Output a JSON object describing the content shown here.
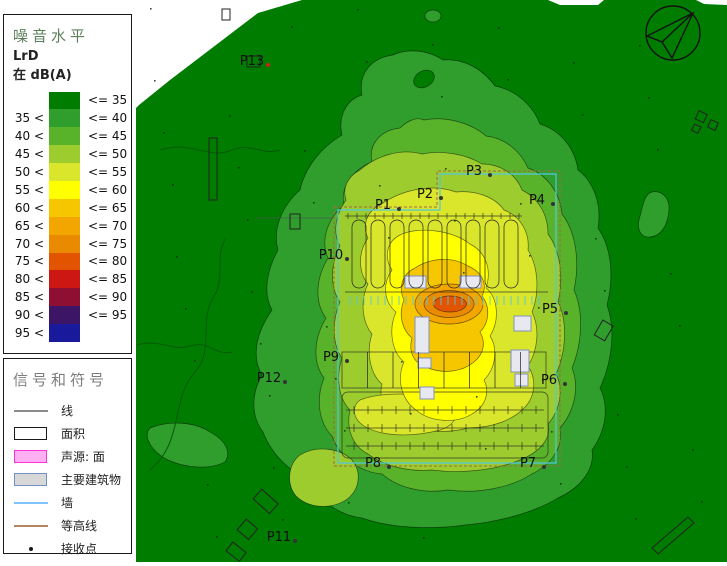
{
  "noise_legend": {
    "title": "噪音水平",
    "quantity": "LrD",
    "unit_line": "在 dB(A)",
    "rows": [
      {
        "from": "",
        "to": "<= 35",
        "color": "#007d00"
      },
      {
        "from": "35 <",
        "to": "<= 40",
        "color": "#2f9e2d"
      },
      {
        "from": "40 <",
        "to": "<= 45",
        "color": "#58b22a"
      },
      {
        "from": "45 <",
        "to": "<= 50",
        "color": "#9ccc2e"
      },
      {
        "from": "50 <",
        "to": "<= 55",
        "color": "#d9e62b"
      },
      {
        "from": "55 <",
        "to": "<= 60",
        "color": "#ffff00"
      },
      {
        "from": "60 <",
        "to": "<= 65",
        "color": "#f6c700"
      },
      {
        "from": "65 <",
        "to": "<= 70",
        "color": "#f4a600"
      },
      {
        "from": "70 <",
        "to": "<= 75",
        "color": "#ea8a00"
      },
      {
        "from": "75 <",
        "to": "<= 80",
        "color": "#e35400"
      },
      {
        "from": "80 <",
        "to": "<= 85",
        "color": "#cd1712"
      },
      {
        "from": "85 <",
        "to": "<= 90",
        "color": "#8f0f32"
      },
      {
        "from": "90 <",
        "to": "<= 95",
        "color": "#3c1566"
      },
      {
        "from": "95 <",
        "to": "",
        "color": "#19199b"
      }
    ]
  },
  "symbol_legend": {
    "title": "信号和符号",
    "items": [
      {
        "label": "线",
        "type": "line",
        "color": "#8c8c8c"
      },
      {
        "label": "面积",
        "type": "rect",
        "fill": "#ffffff",
        "border": "#1a1a1a"
      },
      {
        "label": "声源: 面",
        "type": "rect",
        "fill": "#ffb0f2",
        "border": "#ff30e0"
      },
      {
        "label": "主要建筑物",
        "type": "rect",
        "fill": "#d8d8d8",
        "border": "#7090c8"
      },
      {
        "label": "墙",
        "type": "line",
        "color": "#7fc3ff"
      },
      {
        "label": "等高线",
        "type": "line",
        "color": "#b8835f"
      },
      {
        "label": "接收点",
        "type": "dot",
        "color": "#1a1a1a"
      }
    ]
  },
  "map": {
    "receivers": [
      {
        "id": "P1",
        "x": 383,
        "y": 205
      },
      {
        "id": "P2",
        "x": 425,
        "y": 194
      },
      {
        "id": "P3",
        "x": 474,
        "y": 171
      },
      {
        "id": "P4",
        "x": 537,
        "y": 200
      },
      {
        "id": "P5",
        "x": 550,
        "y": 309
      },
      {
        "id": "P6",
        "x": 549,
        "y": 380
      },
      {
        "id": "P7",
        "x": 528,
        "y": 463
      },
      {
        "id": "P8",
        "x": 373,
        "y": 463
      },
      {
        "id": "P9",
        "x": 331,
        "y": 357
      },
      {
        "id": "P10",
        "x": 331,
        "y": 255
      },
      {
        "id": "P11",
        "x": 279,
        "y": 537
      },
      {
        "id": "P12",
        "x": 269,
        "y": 378
      },
      {
        "id": "P13",
        "x": 252,
        "y": 61,
        "dot": "#cc2218"
      }
    ]
  }
}
